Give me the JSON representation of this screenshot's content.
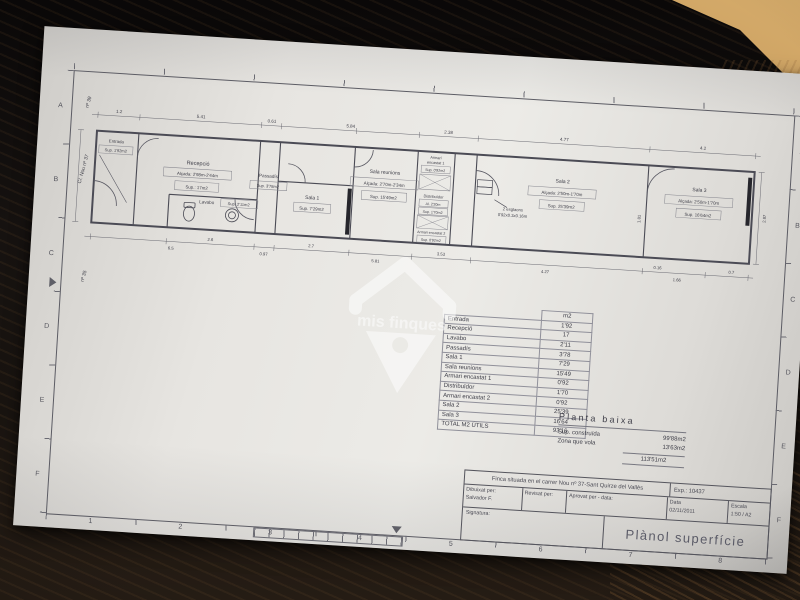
{
  "watermark": {
    "text": "mis finques"
  },
  "sheet": {
    "grid_letters": [
      "A",
      "B",
      "C",
      "D",
      "E",
      "F"
    ],
    "grid_numbers": [
      "1",
      "2",
      "3",
      "4",
      "5",
      "6",
      "7",
      "8"
    ]
  },
  "plan": {
    "street": {
      "above": "nº 39",
      "name": "C/. Nou nº 37",
      "below": "nº 35"
    },
    "rooms": {
      "entrada": {
        "name": "Entrada",
        "sup": "Sup. 1'92m2"
      },
      "recepcio": {
        "name": "Recepció",
        "alcada": "Alçada: 2'98m-2'44m",
        "sup": "Sup.: 17m2"
      },
      "lavabo": {
        "name": "Lavabo",
        "sup": "Sup. 2'11m2"
      },
      "passadis": {
        "name": "Passadís",
        "sup": "Sup. 3'78m2"
      },
      "sala1": {
        "name": "Sala 1",
        "sup": "Sup. 7'29m2"
      },
      "sala_reunions": {
        "name": "Sala reunions",
        "alcada": "Alçada: 2'70m-2'34m",
        "sup": "Sup. 15'49m2"
      },
      "armari1": {
        "name1": "Armari",
        "name2": "encastat 1",
        "sup": "Sup. 0'92m2"
      },
      "distribuidor": {
        "name": "Distribuïdor",
        "alcada": "Al. 2'20m",
        "sup": "Sup. 1'70m2"
      },
      "armari2": {
        "name": "Armari encastat 2",
        "sup": "Sup. 0'92m2"
      },
      "sala2": {
        "name": "Sala 2",
        "alcada": "Alçada: 2'50m-1'70m",
        "sup": "Sup. 25'39m2"
      },
      "sala3": {
        "name": "Sala 3",
        "alcada": "Alçada: 2'50m-1'70m",
        "sup": "Sup. 16'64m2"
      }
    },
    "steps_note_1": "2 esglaons",
    "steps_note_2": "0'92x0.3x0.16m",
    "dims_top": [
      "1.2",
      "5.41",
      "0.61",
      "5.84",
      "2.38",
      "4.77",
      "4.2"
    ],
    "dims_bottom_upper": [
      "2.6",
      "2.7",
      "3.53",
      "0.16",
      "0.7"
    ],
    "dims_bottom_lower": [
      "6.5",
      "0.97",
      "5.81",
      "4.27",
      "1.66"
    ],
    "dims_right": [
      "2.87",
      "1.81"
    ]
  },
  "area_table": {
    "unit_header": "m2",
    "rows": [
      {
        "label": "Entrada",
        "value": "1'92"
      },
      {
        "label": "Recepció",
        "value": "17"
      },
      {
        "label": "Lavabo",
        "value": "2'11"
      },
      {
        "label": "Passadís",
        "value": "3'78"
      },
      {
        "label": "Sala 1",
        "value": "7'29"
      },
      {
        "label": "Sala reunions",
        "value": "15'49"
      },
      {
        "label": "Armari encastat 1",
        "value": "0'92"
      },
      {
        "label": "Distribuïdor",
        "value": "1'70"
      },
      {
        "label": "Armari encastat 2",
        "value": "0'92"
      },
      {
        "label": "Sala 2",
        "value": "25'39"
      },
      {
        "label": "Sala 3",
        "value": "16'64"
      }
    ],
    "total_label": "TOTAL M2 ÚTILS",
    "total_value": "93'16"
  },
  "planta_baixa": {
    "title": "Planta baixa",
    "sup_construida_label": "Sup. construïda",
    "sup_construida_value": "99'88m2",
    "zona_vola_label": "Zona que vola",
    "zona_vola_value": "13'63m2",
    "total_value": "113'51m2"
  },
  "title_block": {
    "finca": "Finca situada en el carrer Nou nº 37-Sant Quirze del Vallès",
    "exp": "Exp.: 10437",
    "dibuixat_label": "Dibuixat per:",
    "dibuixat_value": "Salvador F.",
    "revisat_label": "Revisat per:",
    "aprovat_label": "Aprovat per - data:",
    "data_label": "Data",
    "data_value": "02/11/2011",
    "escala_label": "Escala",
    "escala_value": "1:50 / A2",
    "signatura_label": "Signatura:",
    "title": "Plànol superfície"
  }
}
